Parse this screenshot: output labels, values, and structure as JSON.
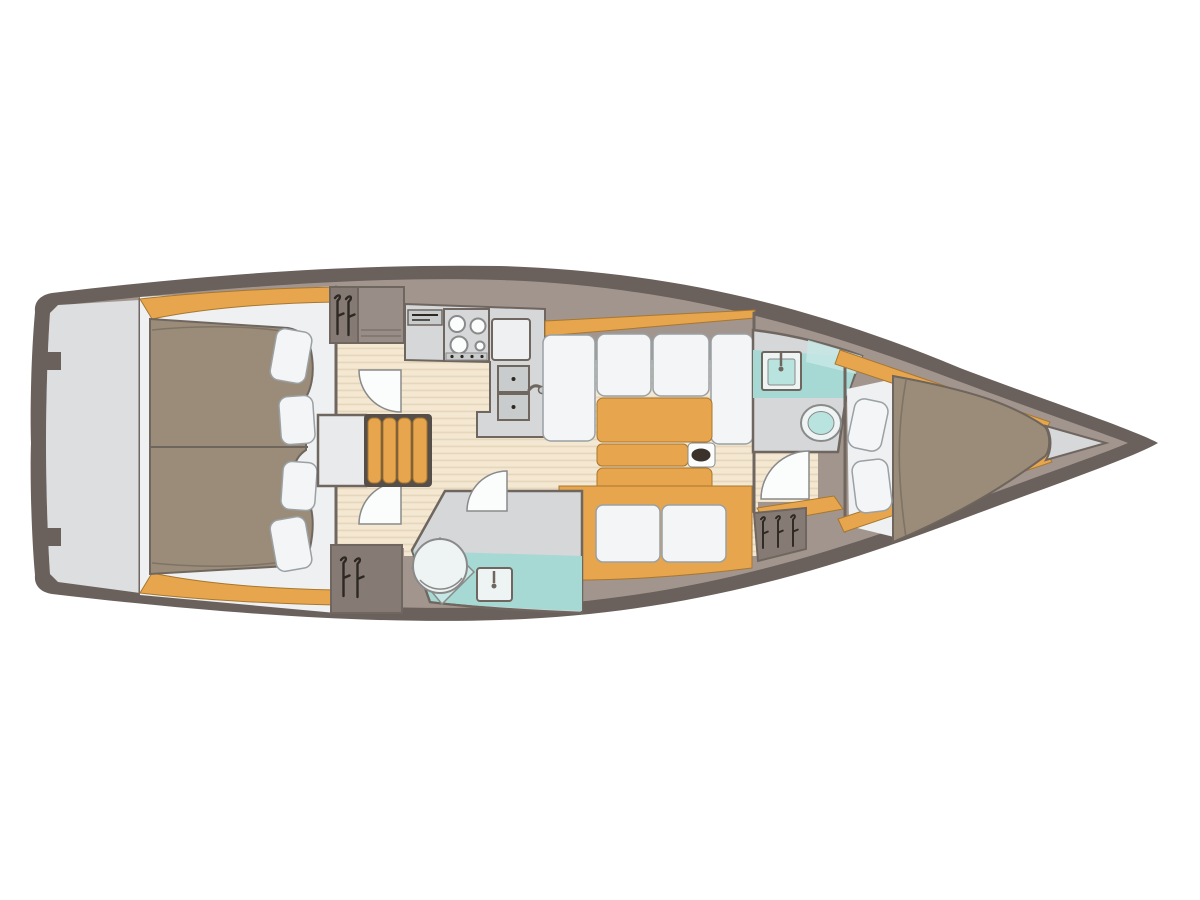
{
  "page": {
    "title": "Sailing yacht interior deck plan, top view, bow pointing right",
    "background": "#ffffff"
  },
  "palette": {
    "hull": "#6a605c",
    "wall": "#a2958d",
    "wallEdge": "#6f6660",
    "edgeGray": "#8a8a8a",
    "platform": "#dcdee0",
    "bowLocker": "#d6d8da",
    "wood": "#e7a64e",
    "woodEdge": "#a8772f",
    "floor": "#f4e8d3",
    "floorLine": "#e4d2b5",
    "berth": "#9a8c78",
    "berthEdge": "#6e655c",
    "linen": "#eef0f1",
    "cushion": "#f3f5f6",
    "cushionEdge": "#9aa0a4",
    "counter": "#d5d7d8",
    "steel": "#c9cccd",
    "aqua": "#a6d8d4",
    "aquaLight": "#c5e8e5",
    "fixture": "#eef4f3",
    "lidAqua": "#b9e3df",
    "locker": "#857a74",
    "stepsFrame": "#564e49",
    "engineBox": "#e9eaeb",
    "hanger": "#2e2823",
    "post": "#3a322b",
    "white": "#fbfcfc",
    "shelfGray": "#998e87"
  },
  "diagram": {
    "type": "yacht-deck-plan",
    "orientation": "bow-right",
    "areas": [
      {
        "name": "swim-platform",
        "label": "Stern swim platform"
      },
      {
        "name": "aft-cabin",
        "label": "Aft double cabin",
        "features": [
          "double berth",
          "duvet",
          "4 pillows",
          "wardrobe lockers"
        ]
      },
      {
        "name": "companionway",
        "label": "Companionway",
        "features": [
          "4-tread steps",
          "engine box",
          "2 cabin doors"
        ]
      },
      {
        "name": "galley",
        "label": "Galley",
        "features": [
          "control panel",
          "stove with burners",
          "worktop",
          "double sink",
          "faucet"
        ]
      },
      {
        "name": "salon",
        "label": "Salon",
        "features": [
          "U-shaped settee",
          "folding table",
          "mast post",
          "two-seat bench",
          "side table"
        ]
      },
      {
        "name": "aft-head",
        "label": "Aft head",
        "features": [
          "shower pan",
          "round basin",
          "sink with faucet",
          "door"
        ]
      },
      {
        "name": "forward-head",
        "label": "Forward head",
        "features": [
          "shower area",
          "sink with faucet",
          "toilet",
          "door"
        ]
      },
      {
        "name": "forward-locker",
        "label": "Hanging locker",
        "features": [
          "3 hangers"
        ]
      },
      {
        "name": "forward-cabin",
        "label": "Forward V-berth cabin",
        "features": [
          "tapered berth",
          "2 pillows",
          "hull shelves"
        ]
      },
      {
        "name": "anchor-locker",
        "label": "Bow anchor locker"
      }
    ]
  }
}
